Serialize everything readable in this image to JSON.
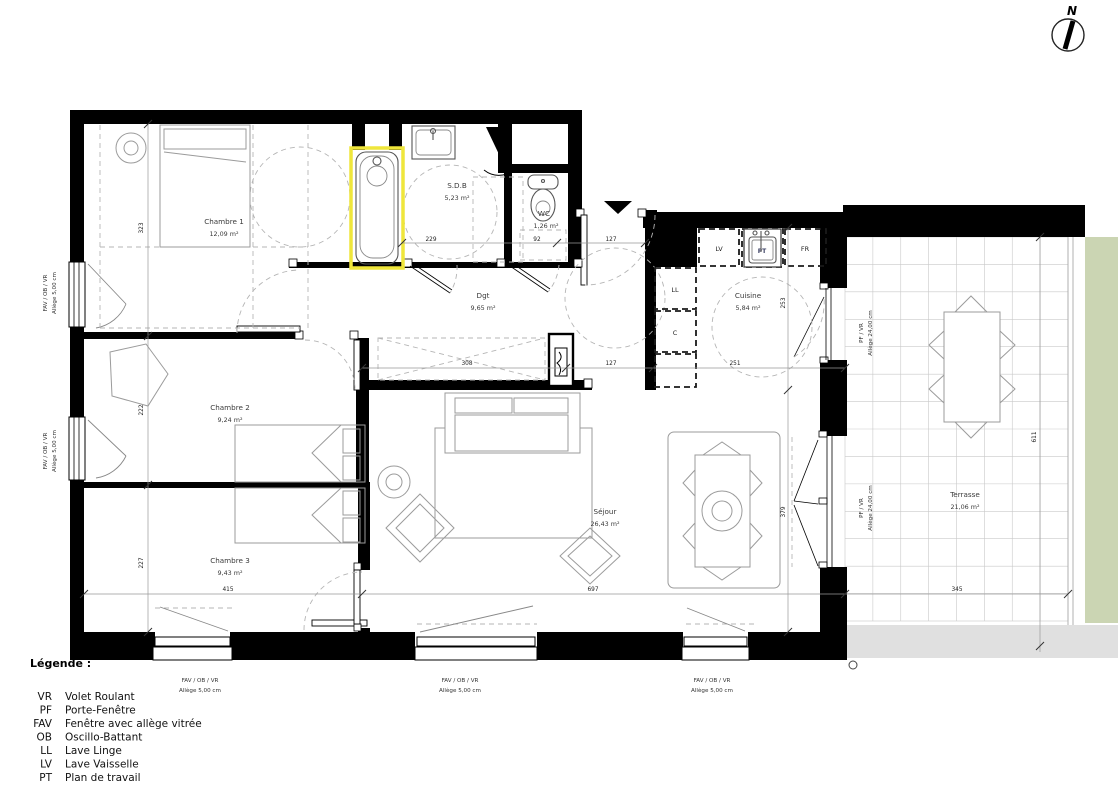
{
  "compass": {
    "north": "N"
  },
  "rooms": {
    "ch1": {
      "name": "Chambre 1",
      "area": "12,09 m²"
    },
    "sdb": {
      "name": "S.D.B",
      "area": "5,23 m²"
    },
    "wc": {
      "name": "WC",
      "area": "1,26 m²"
    },
    "dgt": {
      "name": "Dgt",
      "area": "9,65 m²"
    },
    "cuisine": {
      "name": "Cuisine",
      "area": "5,84 m²"
    },
    "ch2": {
      "name": "Chambre 2",
      "area": "9,24 m²"
    },
    "ch3": {
      "name": "Chambre 3",
      "area": "9,43 m²"
    },
    "sejour": {
      "name": "Séjour",
      "area": "26,43 m²"
    },
    "terrasse": {
      "name": "Terrasse",
      "area": "21,06 m²"
    }
  },
  "kitchen": {
    "lv": "LV",
    "fr": "FR",
    "ll": "LL",
    "c": "C",
    "pt": "PT"
  },
  "dims": {
    "ch1_h": "323",
    "ch2_h": "222",
    "ch3_h": "227",
    "sdb_w": "229",
    "wc_w": "92",
    "entry_w": "127",
    "hall_w": "308",
    "hall_entry_w": "127",
    "cuisine_w": "251",
    "cuisine_h": "253",
    "sejour_h": "379",
    "ch3_w": "415",
    "sejour_w": "697",
    "terrasse_w": "345",
    "terrasse_h": "611"
  },
  "window_labels": {
    "fav": "FAV / OB / VR",
    "allege5": "Allège  5,00 cm",
    "pf": "PF / VR",
    "allege24": "Allège  24,00 cm"
  },
  "legend": {
    "title": "Légende :",
    "items": [
      {
        "abbr": "VR",
        "label": "Volet Roulant"
      },
      {
        "abbr": "PF",
        "label": "Porte-Fenêtre"
      },
      {
        "abbr": "FAV",
        "label": "Fenêtre avec allège vitrée"
      },
      {
        "abbr": "OB",
        "label": "Oscillo-Battant"
      },
      {
        "abbr": "LL",
        "label": "Lave Linge"
      },
      {
        "abbr": "LV",
        "label": "Lave Vaisselle"
      },
      {
        "abbr": "PT",
        "label": "Plan de travail"
      }
    ]
  },
  "colors": {
    "highlight": "#efe63b",
    "vegetation": "#cbd5b3",
    "slab": "#e0e0e0"
  }
}
